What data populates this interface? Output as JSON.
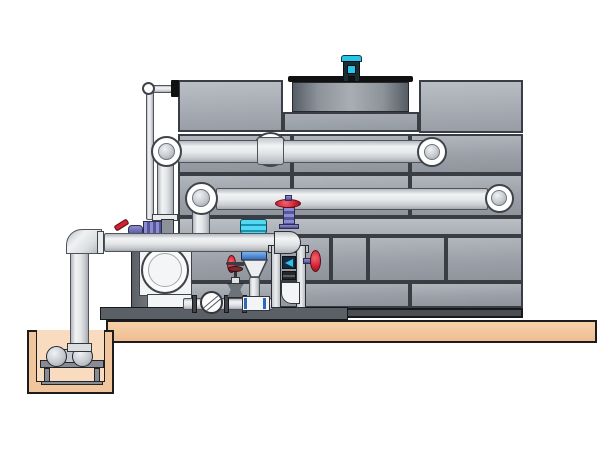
{
  "title": "Closed-circuit cooling tower with pump skid and sump — technical illustration",
  "colors": {
    "panel_edge": "#3a3e44",
    "panel_face": "#9ba0a8",
    "base_strip": "#4a4e54",
    "pipe_edge": "#50545a",
    "pipe_face": "#e5e7e9",
    "slab_tan": "#f4c79c",
    "pit_inner_tan": "#f9dcbf",
    "outline_black": "#1c1c1c",
    "shroud_gray": "#6a7077",
    "motor_cyan": "#2ac4e8",
    "motor_dark": "#1d2b33",
    "valve_red": "#d42033",
    "valve_purple": "#6a6ab0",
    "valve_cyan": "#22bde2",
    "frame_gray": "#d8dadc",
    "navy_box": "#16293f",
    "stand_gray": "#888c92",
    "skid_gray": "#5b5f66"
  },
  "scene": {
    "cooling_tower": {
      "label": "cooling tower casing with bolted panels",
      "fan_shroud": "fan discharge shroud",
      "fan_motor": "fan motor (cyan)",
      "panel_rows": 5
    },
    "piping": {
      "upper_supply_pipe": "upper horizontal spray-supply pipe",
      "middle_return_pipe": "middle horizontal return pipe",
      "lower_header_pipe": "lower pump discharge header",
      "makeup_line": "thin make-up water line",
      "suction_riser": "vertical suction pipe to sump"
    },
    "pump_skid": {
      "main_pump": "end-suction centrifugal pump",
      "check_valve": "wafer check valve",
      "gate_valve": "gate valve with handwheel",
      "balancing_valve": "red handwheel balancing valve",
      "butterfly_valve": "cyan actuated butterfly valve",
      "strainer_cone": "cone strainer / diffuser",
      "flow_meter": "flow indicator in support frame"
    },
    "sump_pit": {
      "label": "concrete sump pit",
      "sump_pump": "horizontal sump pump on stand"
    },
    "foundation": "concrete slab (tan)"
  }
}
